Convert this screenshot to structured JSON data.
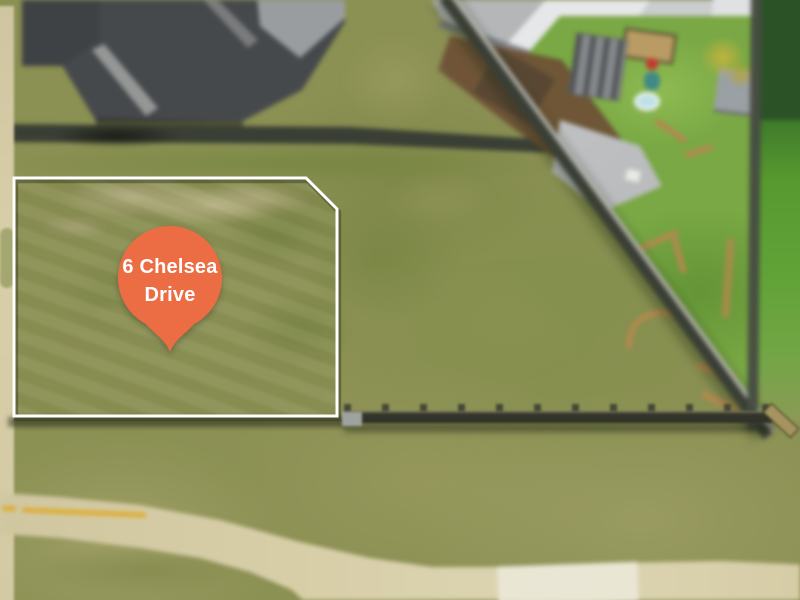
{
  "marker": {
    "line1": "6 Chelsea",
    "line2": "Drive",
    "full_label": "6 Chelsea Drive"
  },
  "colors": {
    "marker_orange": "#EC6C44",
    "marker_text": "#FFFFFF",
    "boundary_white": "#FFFFFF",
    "grass_olive": "#8B9053",
    "turf_green": "#79A844",
    "hedge_green": "#2B5226",
    "lawn_green": "#62A338",
    "roof_dark": "#46494C",
    "roof_light": "#E6E7E8",
    "fence_dark": "#3A3F35",
    "mulch_brown": "#6E5136",
    "timber_tan": "#B08A4E",
    "path_beige": "#D8CFA9",
    "marking_yellow": "#DCAE36",
    "sail_gray": "#D2D4D6",
    "wall_dark": "#33352B"
  }
}
